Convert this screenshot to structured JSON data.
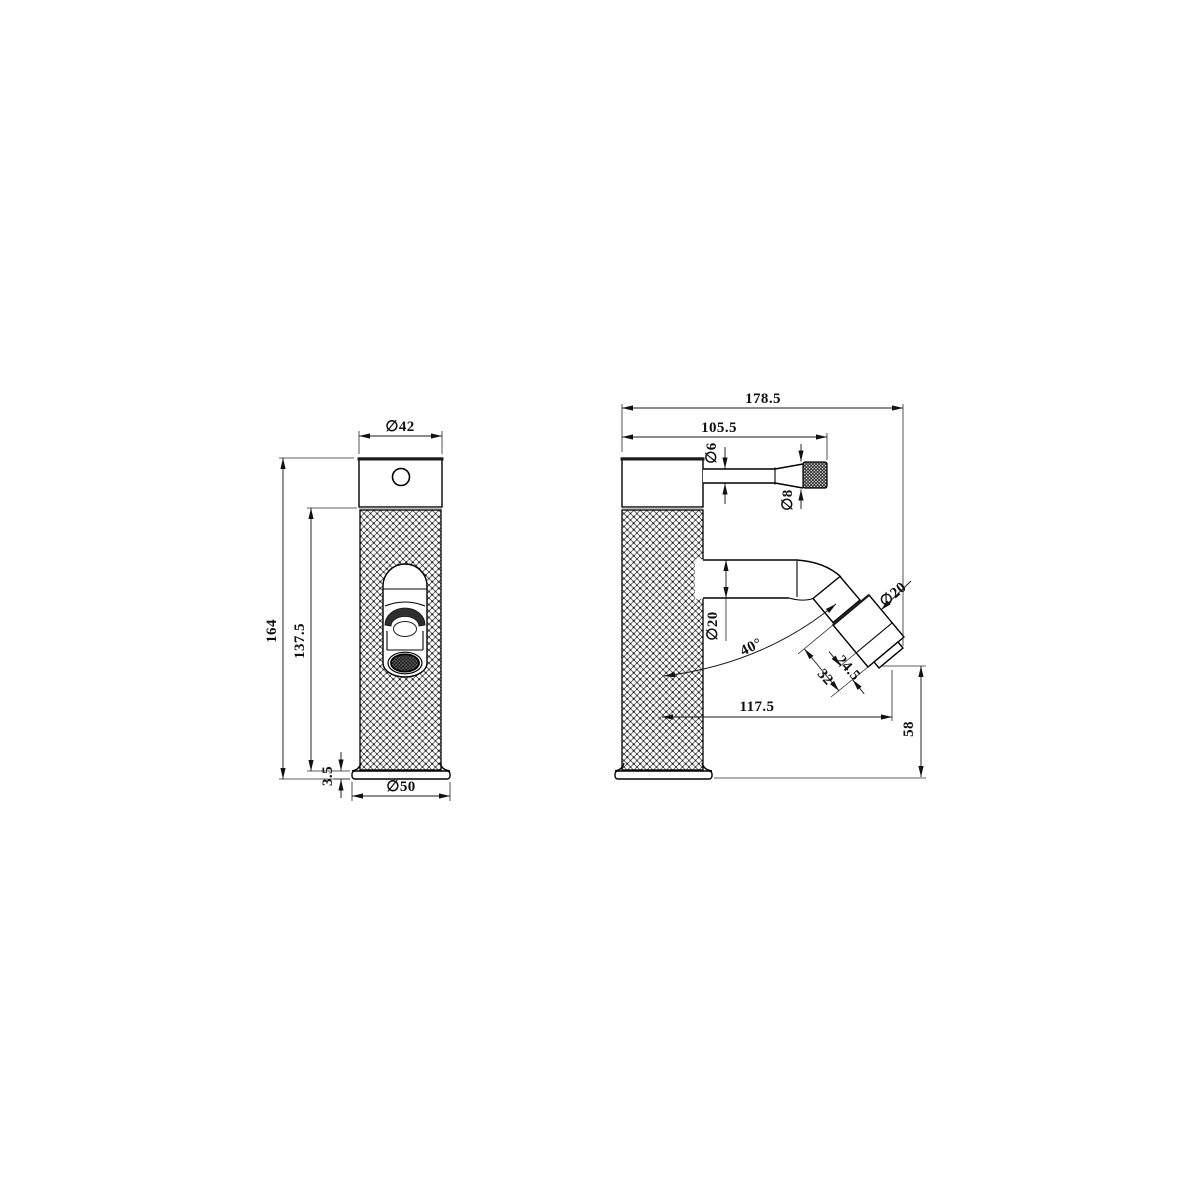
{
  "page": {
    "background": "#ffffff",
    "line_color": "#000000",
    "description": "Two-view CAD dimension drawing of a knurled single-lever basin tap"
  },
  "front_view": {
    "name": "front-view",
    "dims": {
      "top_diameter": "∅42",
      "overall_height": "164",
      "body_height": "137.5",
      "base_thickness": "3.5",
      "base_diameter": "∅50"
    }
  },
  "side_view": {
    "name": "side-view",
    "dims": {
      "overall_length": "178.5",
      "handle_length": "105.5",
      "handle_rod_diameter": "∅6",
      "handle_knob_diameter": "∅8",
      "spout_diameter": "∅20",
      "spout_angle": "40°",
      "outlet_diameter": "∅20",
      "outlet_length_inner": "24.5",
      "outlet_length_outer": "32",
      "spout_reach": "117.5",
      "outlet_height": "58"
    }
  }
}
